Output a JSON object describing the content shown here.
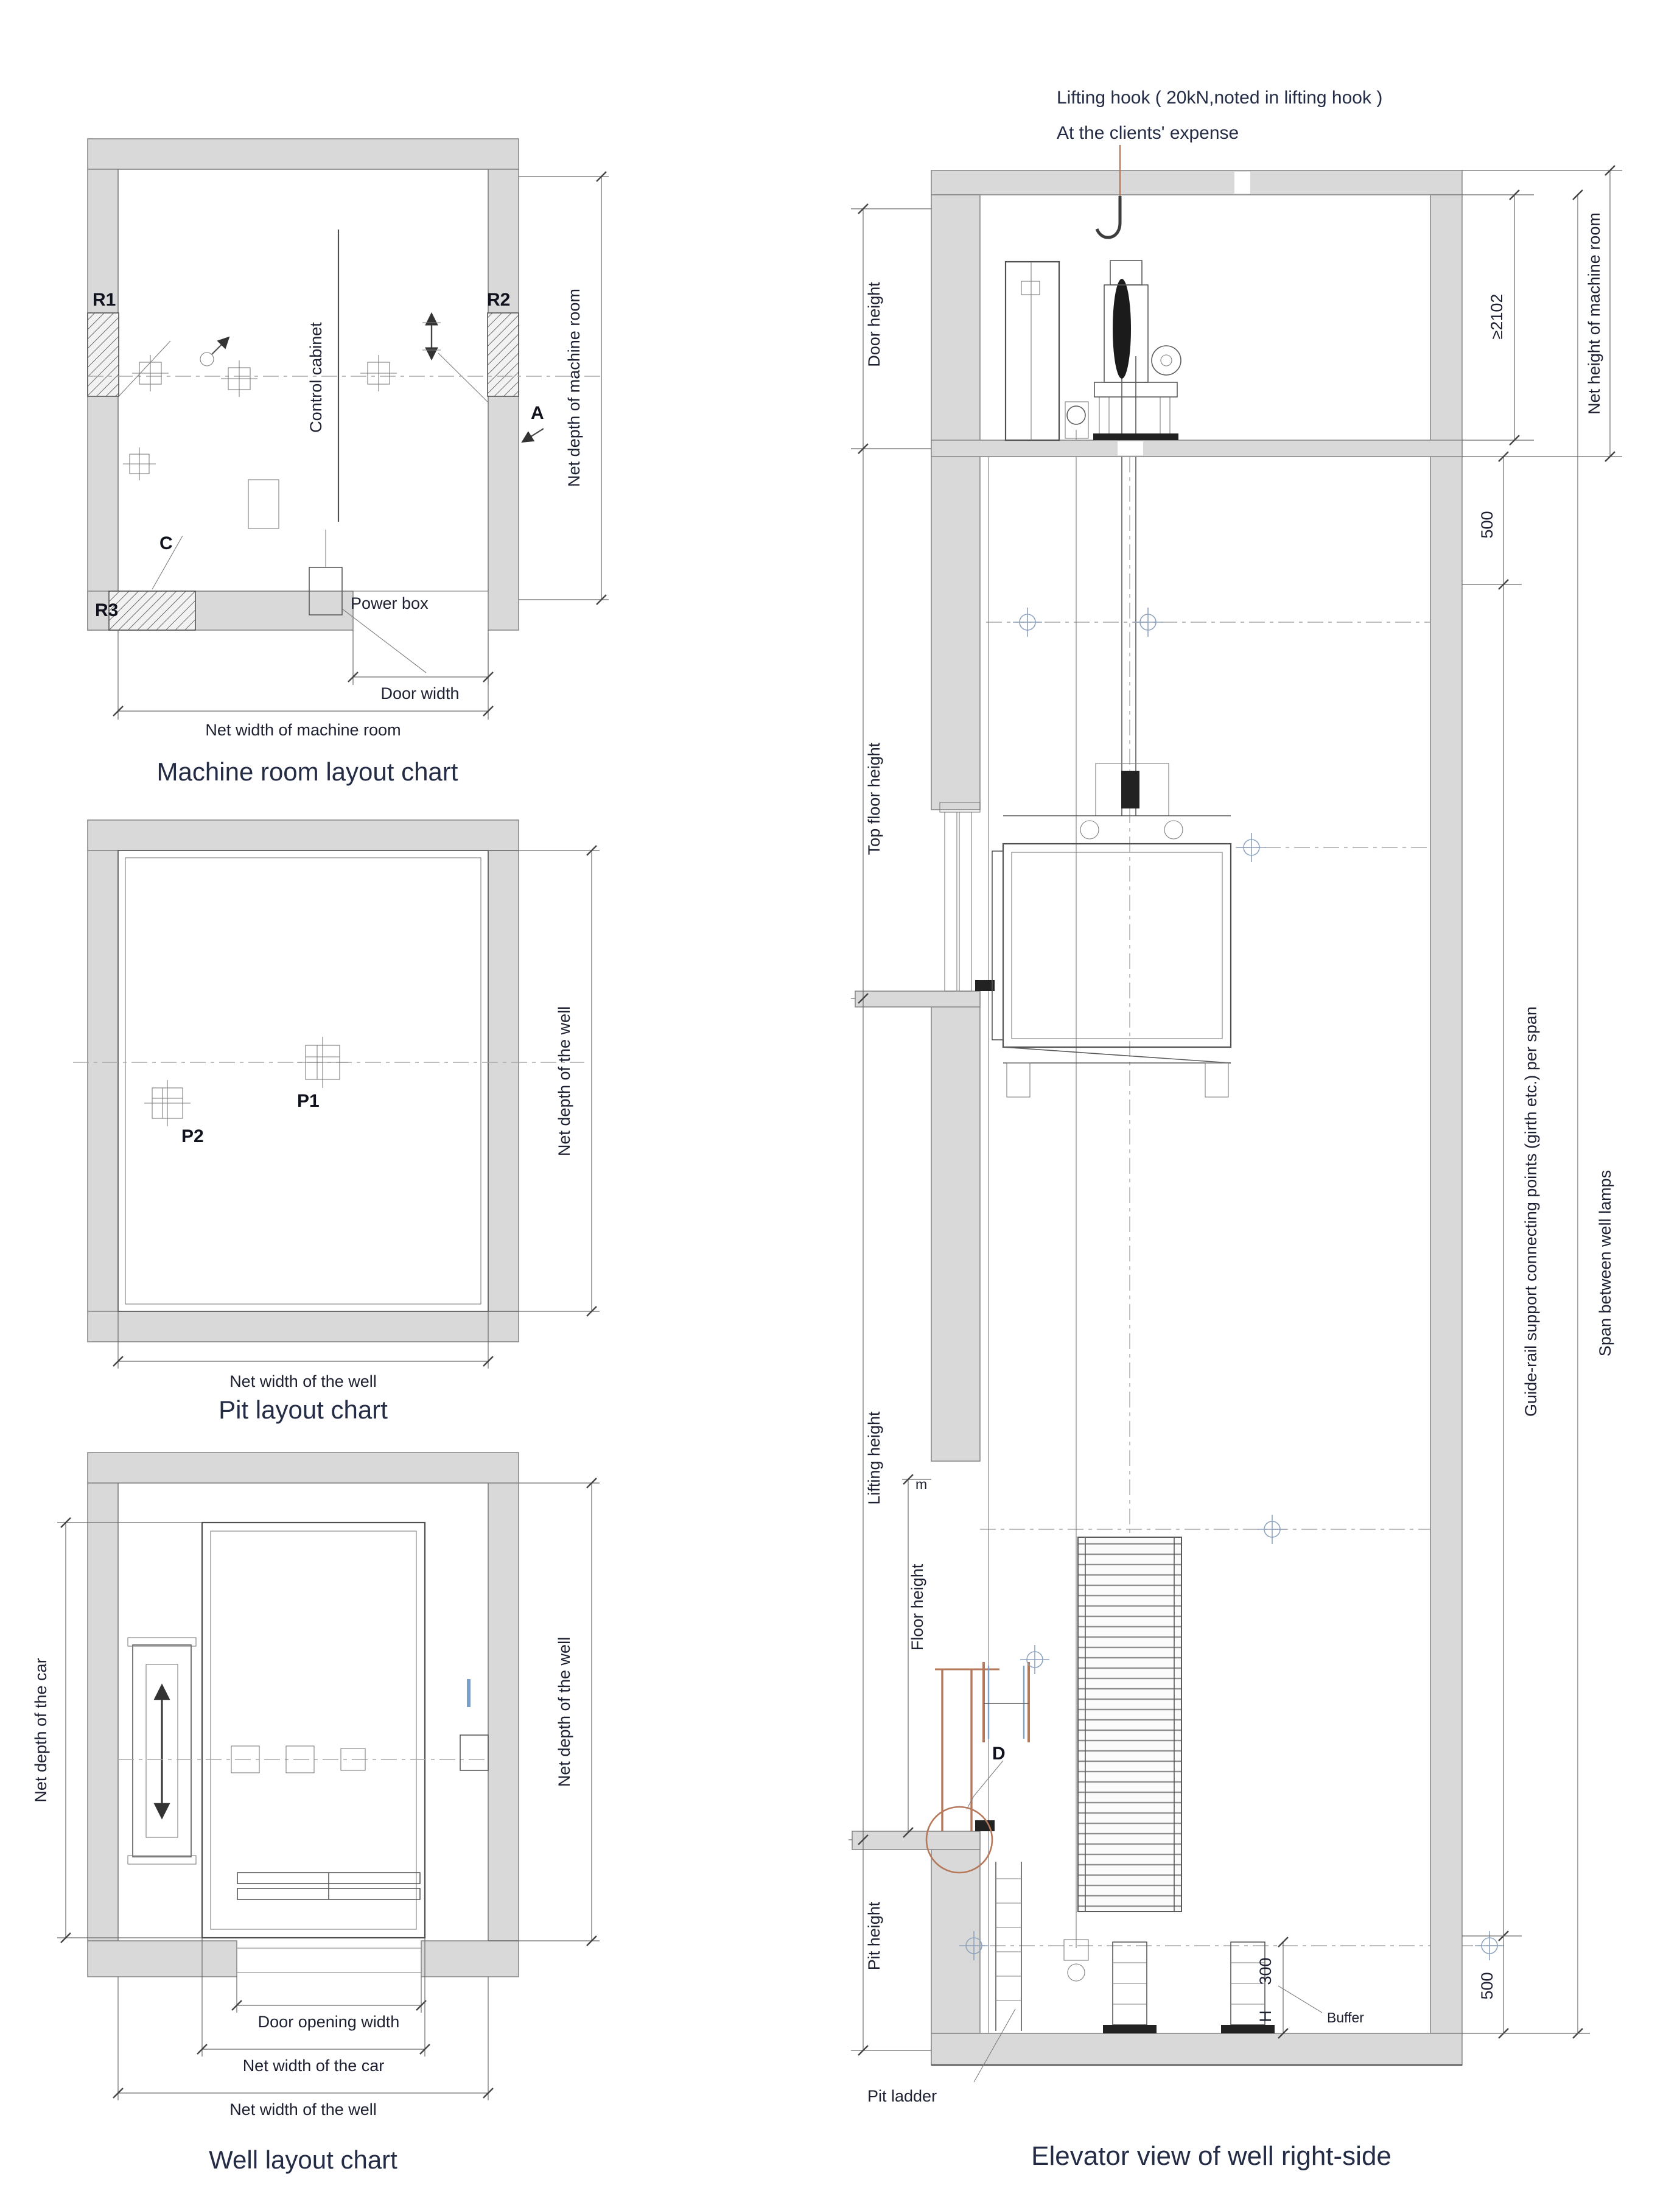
{
  "colors": {
    "wall_fill": "#d9d9d9",
    "line": "#4f4f4f",
    "accent_brown": "#b5785a",
    "accent_blue": "#7aa0c8",
    "title_color": "#232c44"
  },
  "machine_room_chart": {
    "title": "Machine room layout chart",
    "labels": {
      "r1": "R1",
      "r2": "R2",
      "r3": "R3",
      "c": "C",
      "a": "A",
      "control_cabinet": "Control cabinet",
      "power_box": "Power box",
      "door_width": "Door width",
      "net_width": "Net width of machine room",
      "net_depth": "Net depth of machine room"
    }
  },
  "pit_chart": {
    "title": "Pit layout chart",
    "labels": {
      "p1": "P1",
      "p2": "P2",
      "net_width": "Net width of the well",
      "net_depth": "Net depth of the well"
    }
  },
  "well_chart": {
    "title": "Well layout chart",
    "labels": {
      "net_depth_car": "Net depth of the car",
      "net_depth_well": "Net depth of the well",
      "door_opening_width": "Door opening width",
      "net_width_car": "Net width of the car",
      "net_width_well": "Net width of the well"
    }
  },
  "elevation": {
    "title": "Elevator view of well right-side",
    "notes": {
      "lifting_hook_line1": "Lifting hook ( 20kN,noted in lifting hook )",
      "lifting_hook_line2": "At the clients' expense"
    },
    "left_dims": {
      "door_height": "Door height",
      "top_floor_height": "Top floor height",
      "lifting_height": "Lifting height",
      "floor_height": "Floor height",
      "floor_height_suffix": "m",
      "pit_height": "Pit height"
    },
    "right_dims": {
      "machine_room_height": "≥2102",
      "net_height": "Net height of machine room",
      "span_top": "500",
      "span_bottom": "500",
      "guide_rail": "Guide-rail support connecting points (girth etc.) per span",
      "well_lamps": "Span between well lamps",
      "buffer_dim": "300",
      "buffer_dim_suffix": "H"
    },
    "labels": {
      "pit_ladder": "Pit ladder",
      "buffer": "Buffer",
      "door_detail": "D"
    }
  }
}
